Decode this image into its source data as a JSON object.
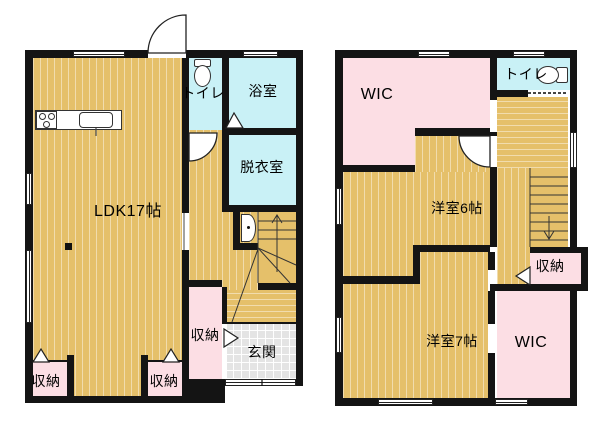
{
  "title": "2-story house floor plan",
  "colors": {
    "bg": "#ffffff",
    "wall": "#141414",
    "wood": "#e5c06a",
    "water": "#c9f1f6",
    "closet": "#fcdee4",
    "tile": "#e4e4e4",
    "line": "#222222"
  },
  "floor1": {
    "ldk": "LDK17帖",
    "toilet": "トイレ",
    "bath": "浴室",
    "dressing": "脱衣室",
    "storage_left": "収納",
    "storage_mid": "収納",
    "storage_hall": "収納",
    "genkan": "玄関"
  },
  "floor2": {
    "wic_top": "WIC",
    "toilet": "トイレ",
    "room6": "洋室6帖",
    "storage": "収納",
    "room7": "洋室7帖",
    "wic_bottom": "WIC"
  },
  "icons": {
    "stairs_up": "up-arrow",
    "stairs_down": "down-arrow",
    "toilet": "toilet-icon",
    "washbasin": "washbasin-icon",
    "stove": "stove-icon",
    "sink": "kitchen-sink-icon"
  }
}
